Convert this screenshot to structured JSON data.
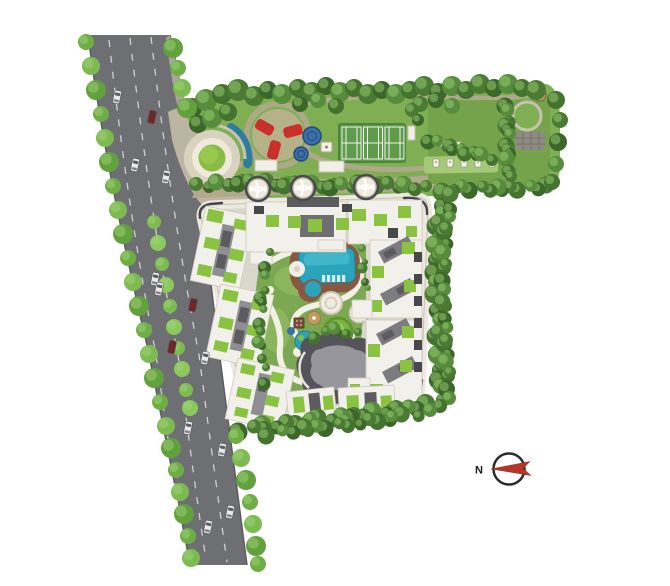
{
  "compass": {
    "north_label": "N"
  },
  "palette": {
    "road": "#6e6f72",
    "lane": "#f2f2f2",
    "apron": "#bdb5a4",
    "lawn": "#7fae53",
    "lawn2": "#75a34c",
    "path": "#b3a88d",
    "ground": "#dad7cd",
    "ring": "#ece9df",
    "roof": "#f2f0ea",
    "core": "#5b5b60",
    "terr": "#8ac341",
    "pool": "#2aa4ba",
    "deck": "#8a5742",
    "tennis": "#5e9c4c",
    "red": "#c9302c",
    "cgreen": "#7ca853",
    "cream": "#f3f0e5",
    "club": "#54545a",
    "club2": "#96969c",
    "cred": "#b73527",
    "car_white": "#e9e9ec",
    "car_red": "#7e2320",
    "hedge_shades": [
      "#4a7a33",
      "#3c672a",
      "#578c3c",
      "#44722f"
    ],
    "tree_shades": [
      "#6fae47",
      "#7dbb52",
      "#63a03e"
    ],
    "median_shades": [
      "#7dbb52",
      "#8bc95e"
    ],
    "tree_highlight": "#a5d87b"
  },
  "road": {
    "cars": [
      [
        117,
        97,
        "w"
      ],
      [
        152,
        117,
        "r"
      ],
      [
        135,
        165,
        "w"
      ],
      [
        166,
        177,
        "w"
      ],
      [
        155,
        279,
        "w"
      ],
      [
        159,
        289,
        "w"
      ],
      [
        193,
        305,
        "r"
      ],
      [
        172,
        347,
        "r"
      ],
      [
        205,
        358,
        "w"
      ],
      [
        188,
        428,
        "w"
      ],
      [
        222,
        450,
        "w"
      ],
      [
        230,
        512,
        "w"
      ],
      [
        208,
        527,
        "w"
      ]
    ],
    "car_angle": 12
  },
  "vegetation": {
    "street_trees": [
      [
        86,
        42
      ],
      [
        91,
        66
      ],
      [
        96,
        90
      ],
      [
        101,
        114
      ],
      [
        105,
        138
      ],
      [
        109,
        162
      ],
      [
        113,
        186
      ],
      [
        118,
        210
      ],
      [
        123,
        234
      ],
      [
        128,
        258
      ],
      [
        133,
        282
      ],
      [
        139,
        306
      ],
      [
        144,
        330
      ],
      [
        149,
        354
      ],
      [
        154,
        378
      ],
      [
        160,
        402
      ],
      [
        166,
        426
      ],
      [
        171,
        448
      ],
      [
        176,
        470
      ],
      [
        180,
        492
      ],
      [
        184,
        514
      ],
      [
        188,
        536
      ],
      [
        191,
        558
      ],
      [
        173,
        48
      ],
      [
        178,
        68
      ],
      [
        182,
        88
      ],
      [
        187,
        108
      ],
      [
        236,
        436
      ],
      [
        241,
        458
      ],
      [
        246,
        480
      ],
      [
        250,
        502
      ],
      [
        253,
        524
      ],
      [
        256,
        546
      ],
      [
        258,
        564
      ]
    ],
    "median_trees": [
      [
        154,
        222
      ],
      [
        158,
        243
      ],
      [
        162,
        264
      ],
      [
        166,
        285
      ],
      [
        170,
        306
      ],
      [
        174,
        327
      ],
      [
        178,
        348
      ],
      [
        182,
        369
      ],
      [
        186,
        390
      ],
      [
        190,
        408
      ]
    ],
    "tree_clusters": [
      [
        192,
        108,
        10
      ],
      [
        206,
        100,
        11
      ],
      [
        222,
        94,
        10
      ],
      [
        238,
        90,
        11
      ],
      [
        198,
        124,
        9
      ],
      [
        212,
        118,
        10
      ],
      [
        228,
        112,
        9
      ],
      [
        254,
        96,
        10
      ],
      [
        268,
        90,
        9
      ],
      [
        282,
        94,
        10
      ],
      [
        298,
        88,
        9
      ],
      [
        312,
        92,
        10
      ],
      [
        326,
        86,
        9
      ],
      [
        340,
        92,
        10
      ],
      [
        354,
        88,
        9
      ],
      [
        368,
        94,
        10
      ],
      [
        382,
        90,
        9
      ],
      [
        396,
        94,
        10
      ],
      [
        410,
        90,
        9
      ],
      [
        424,
        86,
        10
      ],
      [
        438,
        92,
        9
      ],
      [
        452,
        86,
        10
      ],
      [
        466,
        90,
        9
      ],
      [
        480,
        84,
        10
      ],
      [
        494,
        88,
        9
      ],
      [
        508,
        84,
        10
      ],
      [
        522,
        88,
        9
      ],
      [
        536,
        90,
        10
      ],
      [
        300,
        104,
        8
      ],
      [
        318,
        100,
        8
      ],
      [
        336,
        106,
        8
      ],
      [
        420,
        104,
        8
      ],
      [
        436,
        100,
        8
      ],
      [
        452,
        106,
        8
      ],
      [
        556,
        100,
        9
      ],
      [
        560,
        120,
        8
      ],
      [
        558,
        142,
        9
      ],
      [
        556,
        164,
        8
      ],
      [
        552,
        182,
        8
      ],
      [
        412,
        110,
        7
      ],
      [
        418,
        120,
        6
      ]
    ],
    "hedge_lines": [
      {
        "pts": [
          [
            548,
            187
          ],
          [
            500,
            189
          ],
          [
            452,
            188
          ]
        ],
        "r": 7,
        "step": 10
      },
      {
        "pts": [
          [
            444,
            194
          ],
          [
            438,
            224
          ],
          [
            436,
            258
          ],
          [
            436,
            296
          ],
          [
            438,
            334
          ],
          [
            440,
            368
          ],
          [
            441,
            398
          ]
        ],
        "r": 8,
        "step": 11
      },
      {
        "pts": [
          [
            452,
            196
          ],
          [
            446,
            230
          ],
          [
            444,
            266
          ],
          [
            444,
            304
          ],
          [
            446,
            342
          ],
          [
            448,
            374
          ],
          [
            449,
            400
          ]
        ],
        "r": 7,
        "step": 12
      },
      {
        "pts": [
          [
            438,
            404
          ],
          [
            396,
            410
          ],
          [
            352,
            416
          ],
          [
            308,
            421
          ],
          [
            264,
            427
          ],
          [
            240,
            430
          ]
        ],
        "r": 8,
        "step": 11
      },
      {
        "pts": [
          [
            430,
            412
          ],
          [
            390,
            418
          ],
          [
            348,
            424
          ],
          [
            306,
            429
          ],
          [
            268,
            434
          ]
        ],
        "r": 7,
        "step": 12
      },
      {
        "pts": [
          [
            196,
            186
          ],
          [
            240,
            182
          ],
          [
            286,
            184
          ],
          [
            332,
            186
          ],
          [
            378,
            184
          ],
          [
            424,
            188
          ]
        ],
        "r": 7,
        "step": 10
      },
      {
        "pts": [
          [
            507,
            104
          ],
          [
            508,
            128
          ],
          [
            508,
            152
          ],
          [
            509,
            178
          ]
        ],
        "r": 7,
        "step": 9
      },
      {
        "pts": [
          [
            430,
            140
          ],
          [
            452,
            148
          ],
          [
            474,
            154
          ],
          [
            492,
            158
          ]
        ],
        "r": 6,
        "step": 9
      },
      {
        "pts": [
          [
            268,
            254
          ],
          [
            262,
            300
          ],
          [
            260,
            344
          ],
          [
            266,
            382
          ]
        ],
        "r": 5,
        "step": 12
      },
      {
        "pts": [
          [
            362,
            250
          ],
          [
            366,
            290
          ]
        ],
        "r": 4,
        "step": 10
      },
      {
        "pts": [
          [
            316,
            336
          ],
          [
            336,
            330
          ],
          [
            356,
            334
          ]
        ],
        "r": 5,
        "step": 9
      }
    ],
    "planters": [
      [
        258,
        189
      ],
      [
        303,
        188
      ],
      [
        366,
        187
      ]
    ]
  },
  "amenities": {
    "gym_items_x": [
      433,
      447,
      461,
      475,
      489
    ],
    "gym_items_y": 163,
    "tennis_courts": 3
  }
}
